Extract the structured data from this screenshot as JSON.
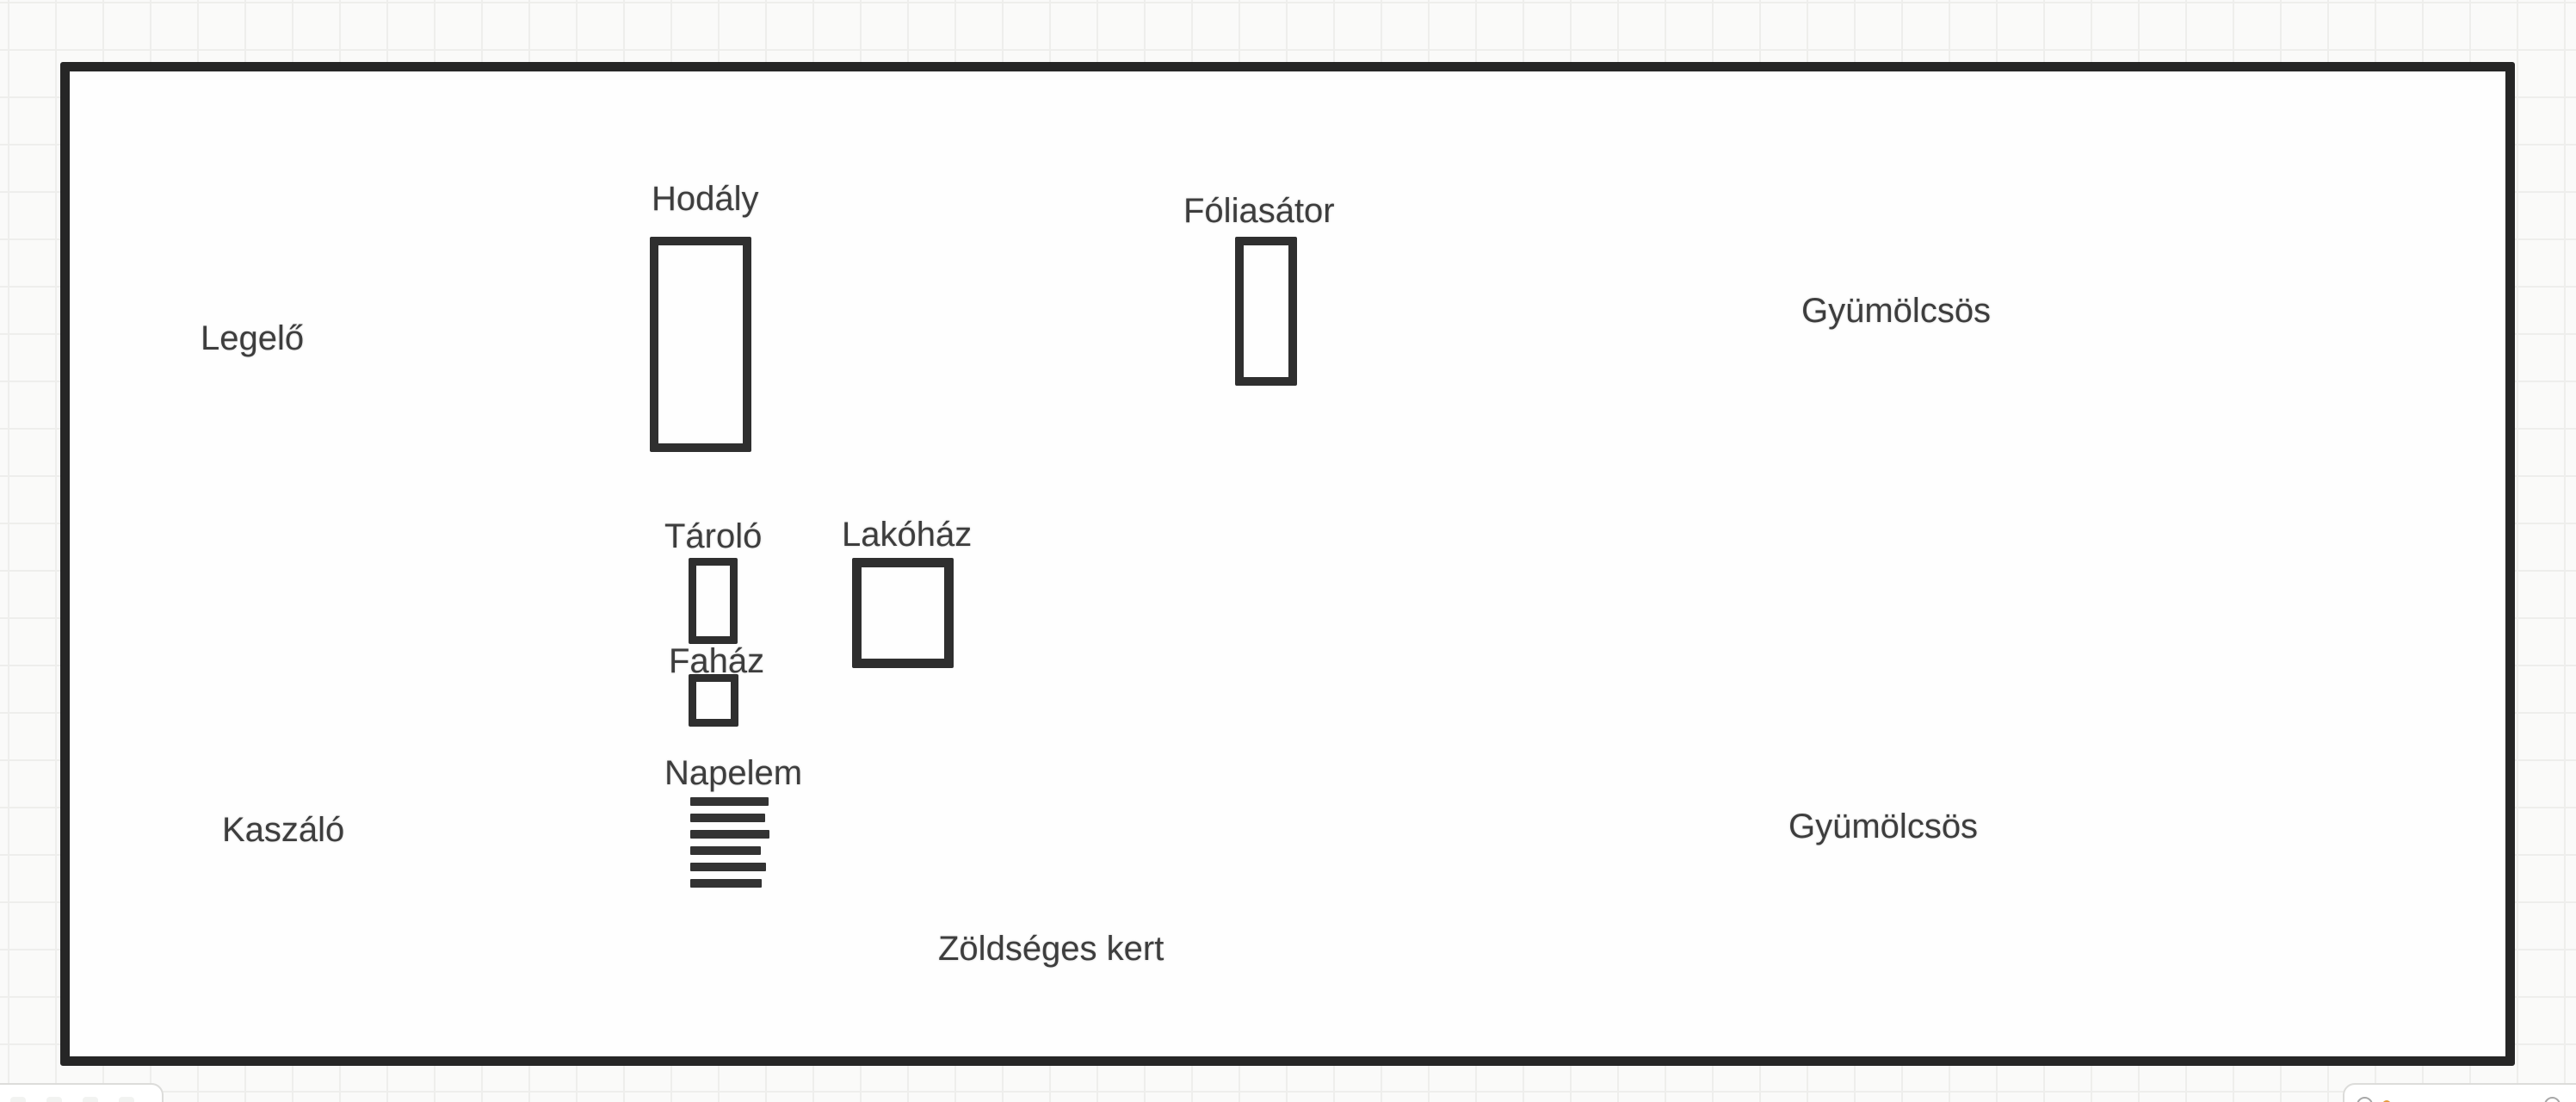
{
  "map": {
    "labels": {
      "hodaly": "Hodály",
      "foliasator": "Fóliasátor",
      "gyumolcsos_top": "Gyümölcsös",
      "legelo": "Legelő",
      "tarolo": "Tároló",
      "lakohaz": "Lakóház",
      "fahaz": "Faház",
      "napelem": "Napelem",
      "kaszalo": "Kaszáló",
      "gyumolcsos_bottom": "Gyümölcsös",
      "zoldseges_kert": "Zöldséges kert"
    },
    "napelem_stripe_count": 6,
    "colors": {
      "boundary_outline": "#262626",
      "building_outline": "#2f2f2f",
      "label_text": "#3d3d3d",
      "canvas_fill": "#fefefe",
      "page_background": "#fafaf9",
      "grid_line": "#eeeeec",
      "accent_dot": "#e59a3c"
    }
  },
  "ui": {
    "bottom_right_toolbar_icons": [
      "circle-swatch",
      "accent-dot",
      "circle-swatch"
    ]
  }
}
